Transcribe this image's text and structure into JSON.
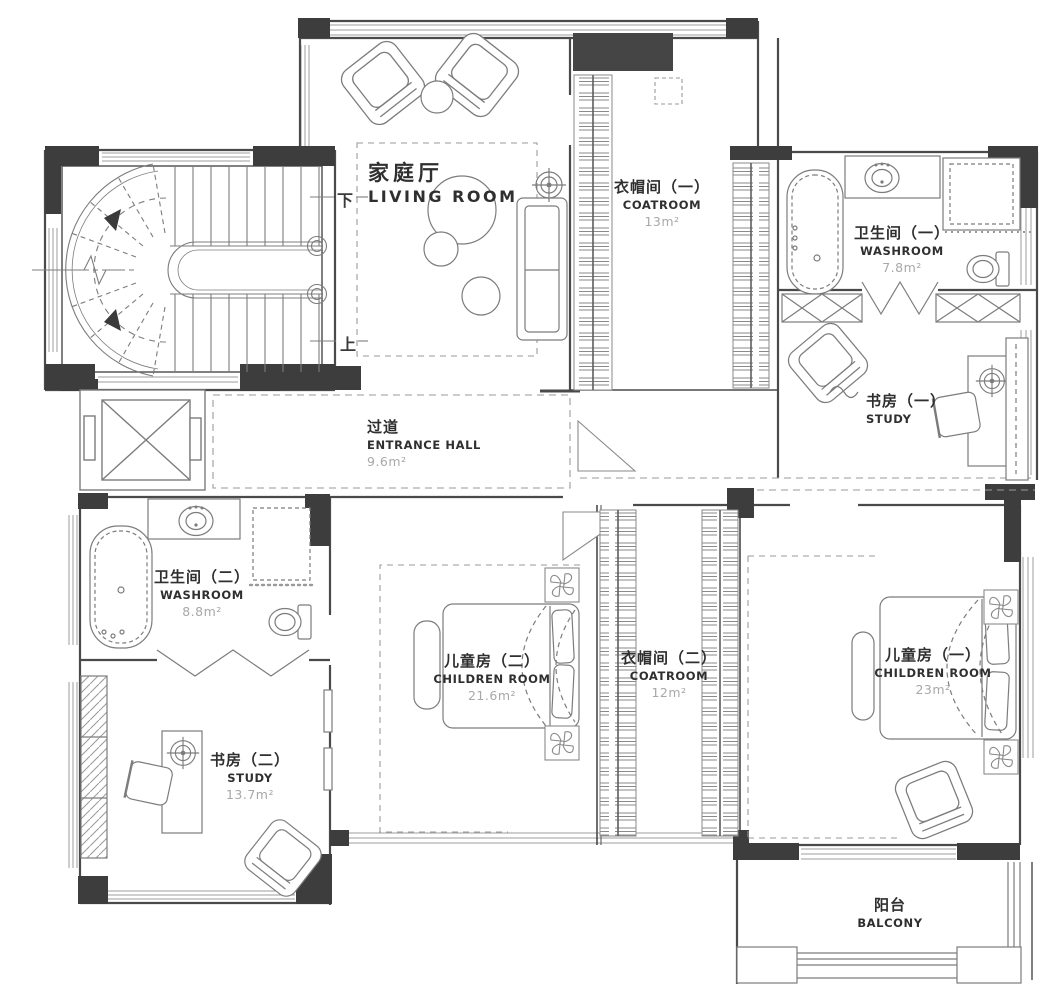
{
  "plan": {
    "type": "residential-floor-plan",
    "colors": {
      "wall": "#3d3d3d",
      "line": "#7c7c7c",
      "dashed": "#9a9a9a",
      "label_text": "#2f2f2f",
      "area_text": "#a8a8a8",
      "background": "#ffffff"
    }
  },
  "rooms": [
    {
      "id": "living-room",
      "zh": "家庭厅",
      "en": "LIVING ROOM",
      "area": ""
    },
    {
      "id": "coatroom-1",
      "zh": "衣帽间（一）",
      "en": "COATROOM",
      "area": "13m²"
    },
    {
      "id": "washroom-1",
      "zh": "卫生间（一）",
      "en": "WASHROOM",
      "area": "7.8m²"
    },
    {
      "id": "study-1",
      "zh": "书房（一）",
      "en": "STUDY",
      "area": ""
    },
    {
      "id": "entrance-hall",
      "zh": "过道",
      "en": "ENTRANCE HALL",
      "area": "9.6m²"
    },
    {
      "id": "washroom-2",
      "zh": "卫生间（二）",
      "en": "WASHROOM",
      "area": "8.8m²"
    },
    {
      "id": "study-2",
      "zh": "书房（二）",
      "en": "STUDY",
      "area": "13.7m²"
    },
    {
      "id": "children-room-2",
      "zh": "儿童房（二）",
      "en": "CHILDREN ROOM",
      "area": "21.6m²"
    },
    {
      "id": "coatroom-2",
      "zh": "衣帽间（二）",
      "en": "COATROOM",
      "area": "12m²"
    },
    {
      "id": "children-room-1",
      "zh": "儿童房（一）",
      "en": "CHILDREN ROOM",
      "area": "23m²"
    },
    {
      "id": "balcony",
      "zh": "阳台",
      "en": "BALCONY",
      "area": ""
    }
  ],
  "stairs": {
    "down": "下",
    "up": "上"
  }
}
